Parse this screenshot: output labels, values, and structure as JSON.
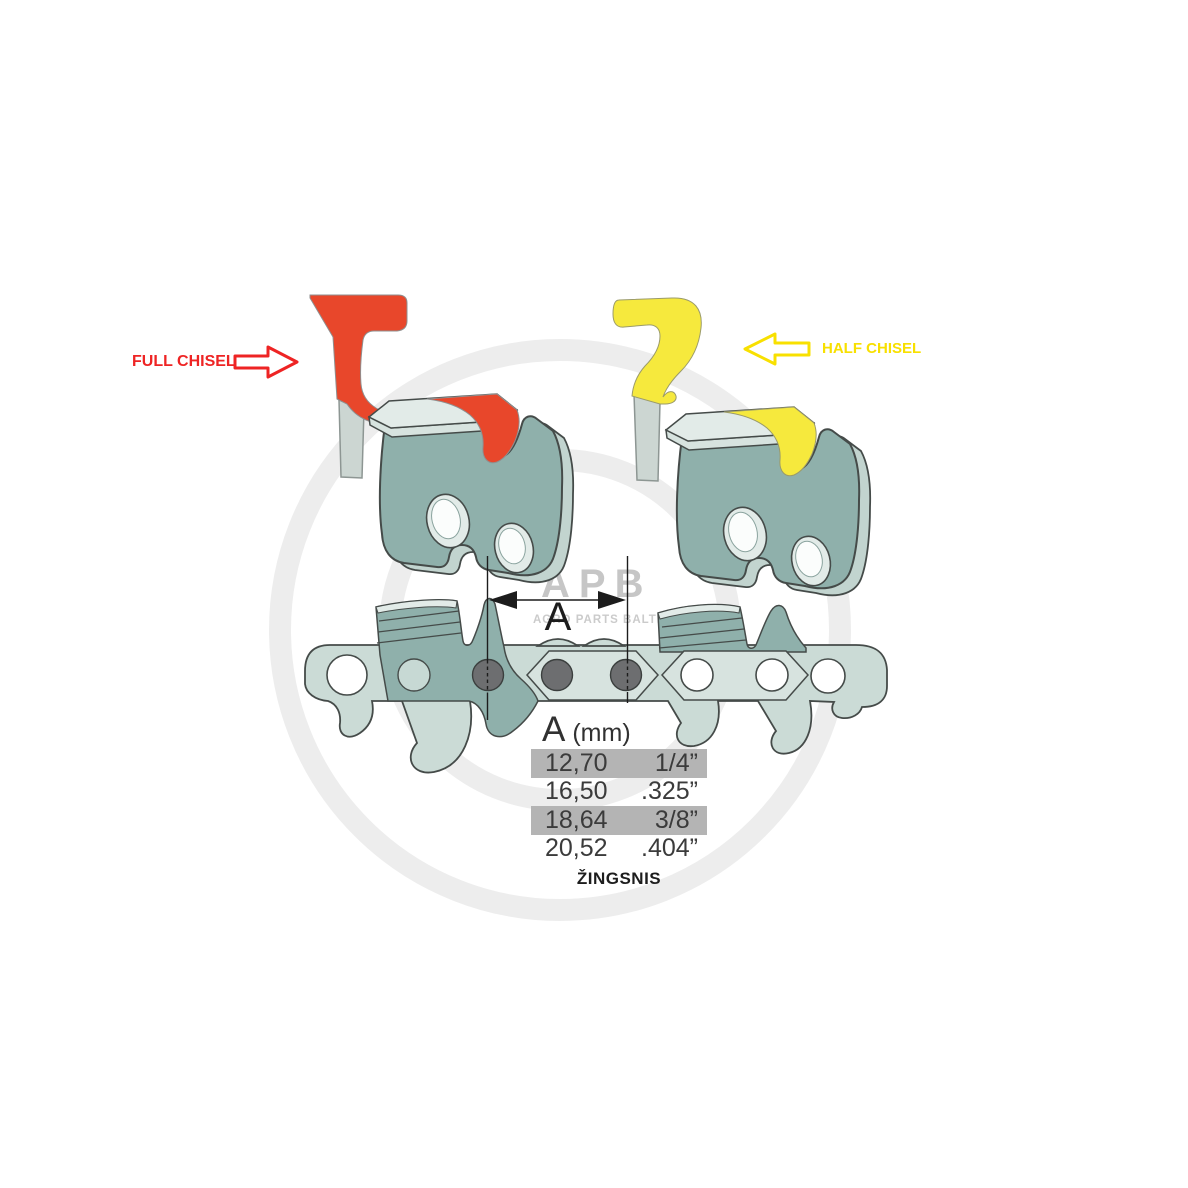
{
  "annotations": {
    "full_chisel": "FULL CHISEL",
    "half_chisel": "HALF CHISEL"
  },
  "dimension": {
    "label": "A"
  },
  "pitch_table": {
    "header_letter": "A",
    "header_unit": "(mm)",
    "rows": [
      {
        "mm": "12,70",
        "inch": "1/4”",
        "highlight": true
      },
      {
        "mm": "16,50",
        "inch": ".325”",
        "highlight": false
      },
      {
        "mm": "18,64",
        "inch": "3/8”",
        "highlight": true
      },
      {
        "mm": "20,52",
        "inch": ".404”",
        "highlight": false
      }
    ],
    "caption": "ŽINGSNIS"
  },
  "watermark": {
    "brand": "APB",
    "subtitle": "AGRO PARTS BALTIJA"
  },
  "icons": {
    "full_chisel_arrow": "arrow-right",
    "half_chisel_arrow": "arrow-left"
  },
  "colors": {
    "accent_red": "#e8472b",
    "label_red": "#ee2424",
    "accent_yellow": "#f6e93d",
    "label_yellow": "#f8e000",
    "teal_dark": "#8fb0ab",
    "teal_back": "#c2d4cf",
    "teal_light": "#cbdbd6",
    "teal_plate": "#d7e3df",
    "teal_top": "#e2ebe8",
    "outline": "#454b49",
    "rivet_gray": "#6d6e70",
    "row_gray": "#b4b4b4",
    "text_dark": "#3a3a3a",
    "watermark_gray": "#b9b9b9",
    "watermark_sub": "#c6c6c6",
    "ring_gray": "#ededed",
    "shank_gray": "#ccd6d2",
    "shank_edge": "#8d9693"
  }
}
